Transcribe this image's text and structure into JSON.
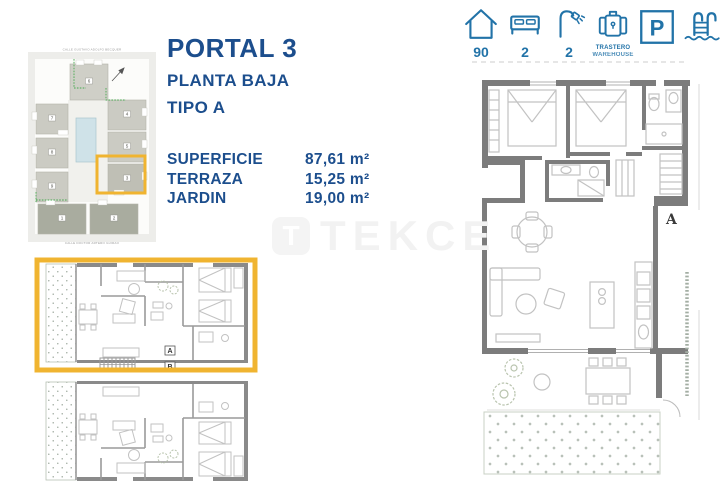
{
  "header": {
    "portal": "PORTAL 3",
    "floor": "PLANTA BAJA",
    "type": "TIPO A",
    "text_color": "#1c4e8d"
  },
  "specs": {
    "rows": [
      {
        "label": "SUPERFICIE",
        "value": "87,61 m²"
      },
      {
        "label": "TERRAZA",
        "value": "15,25 m²"
      },
      {
        "label": "JARDIN",
        "value": "19,00 m²"
      }
    ]
  },
  "features": {
    "color": "#2273a8",
    "parking_letter": "P",
    "items": [
      {
        "icon": "house-icon",
        "value": "90"
      },
      {
        "icon": "bed-icon",
        "value": "2"
      },
      {
        "icon": "shower-icon",
        "value": "2"
      },
      {
        "icon": "storage-icon",
        "label_line1": "TRASTERO",
        "label_line2": "WAREHOUSE"
      },
      {
        "icon": "parking-icon"
      },
      {
        "icon": "pool-icon"
      }
    ]
  },
  "site_plan": {
    "street_top": "CALLE GUSTAVO ADOLFO BECQUER",
    "street_bottom": "CALLE DOCTOR ARTERO GUIRAO",
    "numbers": [
      "6",
      "7",
      "8",
      "9",
      "4",
      "5",
      "3",
      "1",
      "2"
    ],
    "highlighted_building": "3",
    "highlight_color": "#f0b430"
  },
  "floor_plan_right": {
    "section_label": "A"
  },
  "floor_plan_left": {
    "unit_a": "A",
    "unit_b": "B",
    "highlight_color": "#f0b430"
  },
  "watermark": {
    "text": "TEKCE",
    "logo_letter": "T"
  }
}
